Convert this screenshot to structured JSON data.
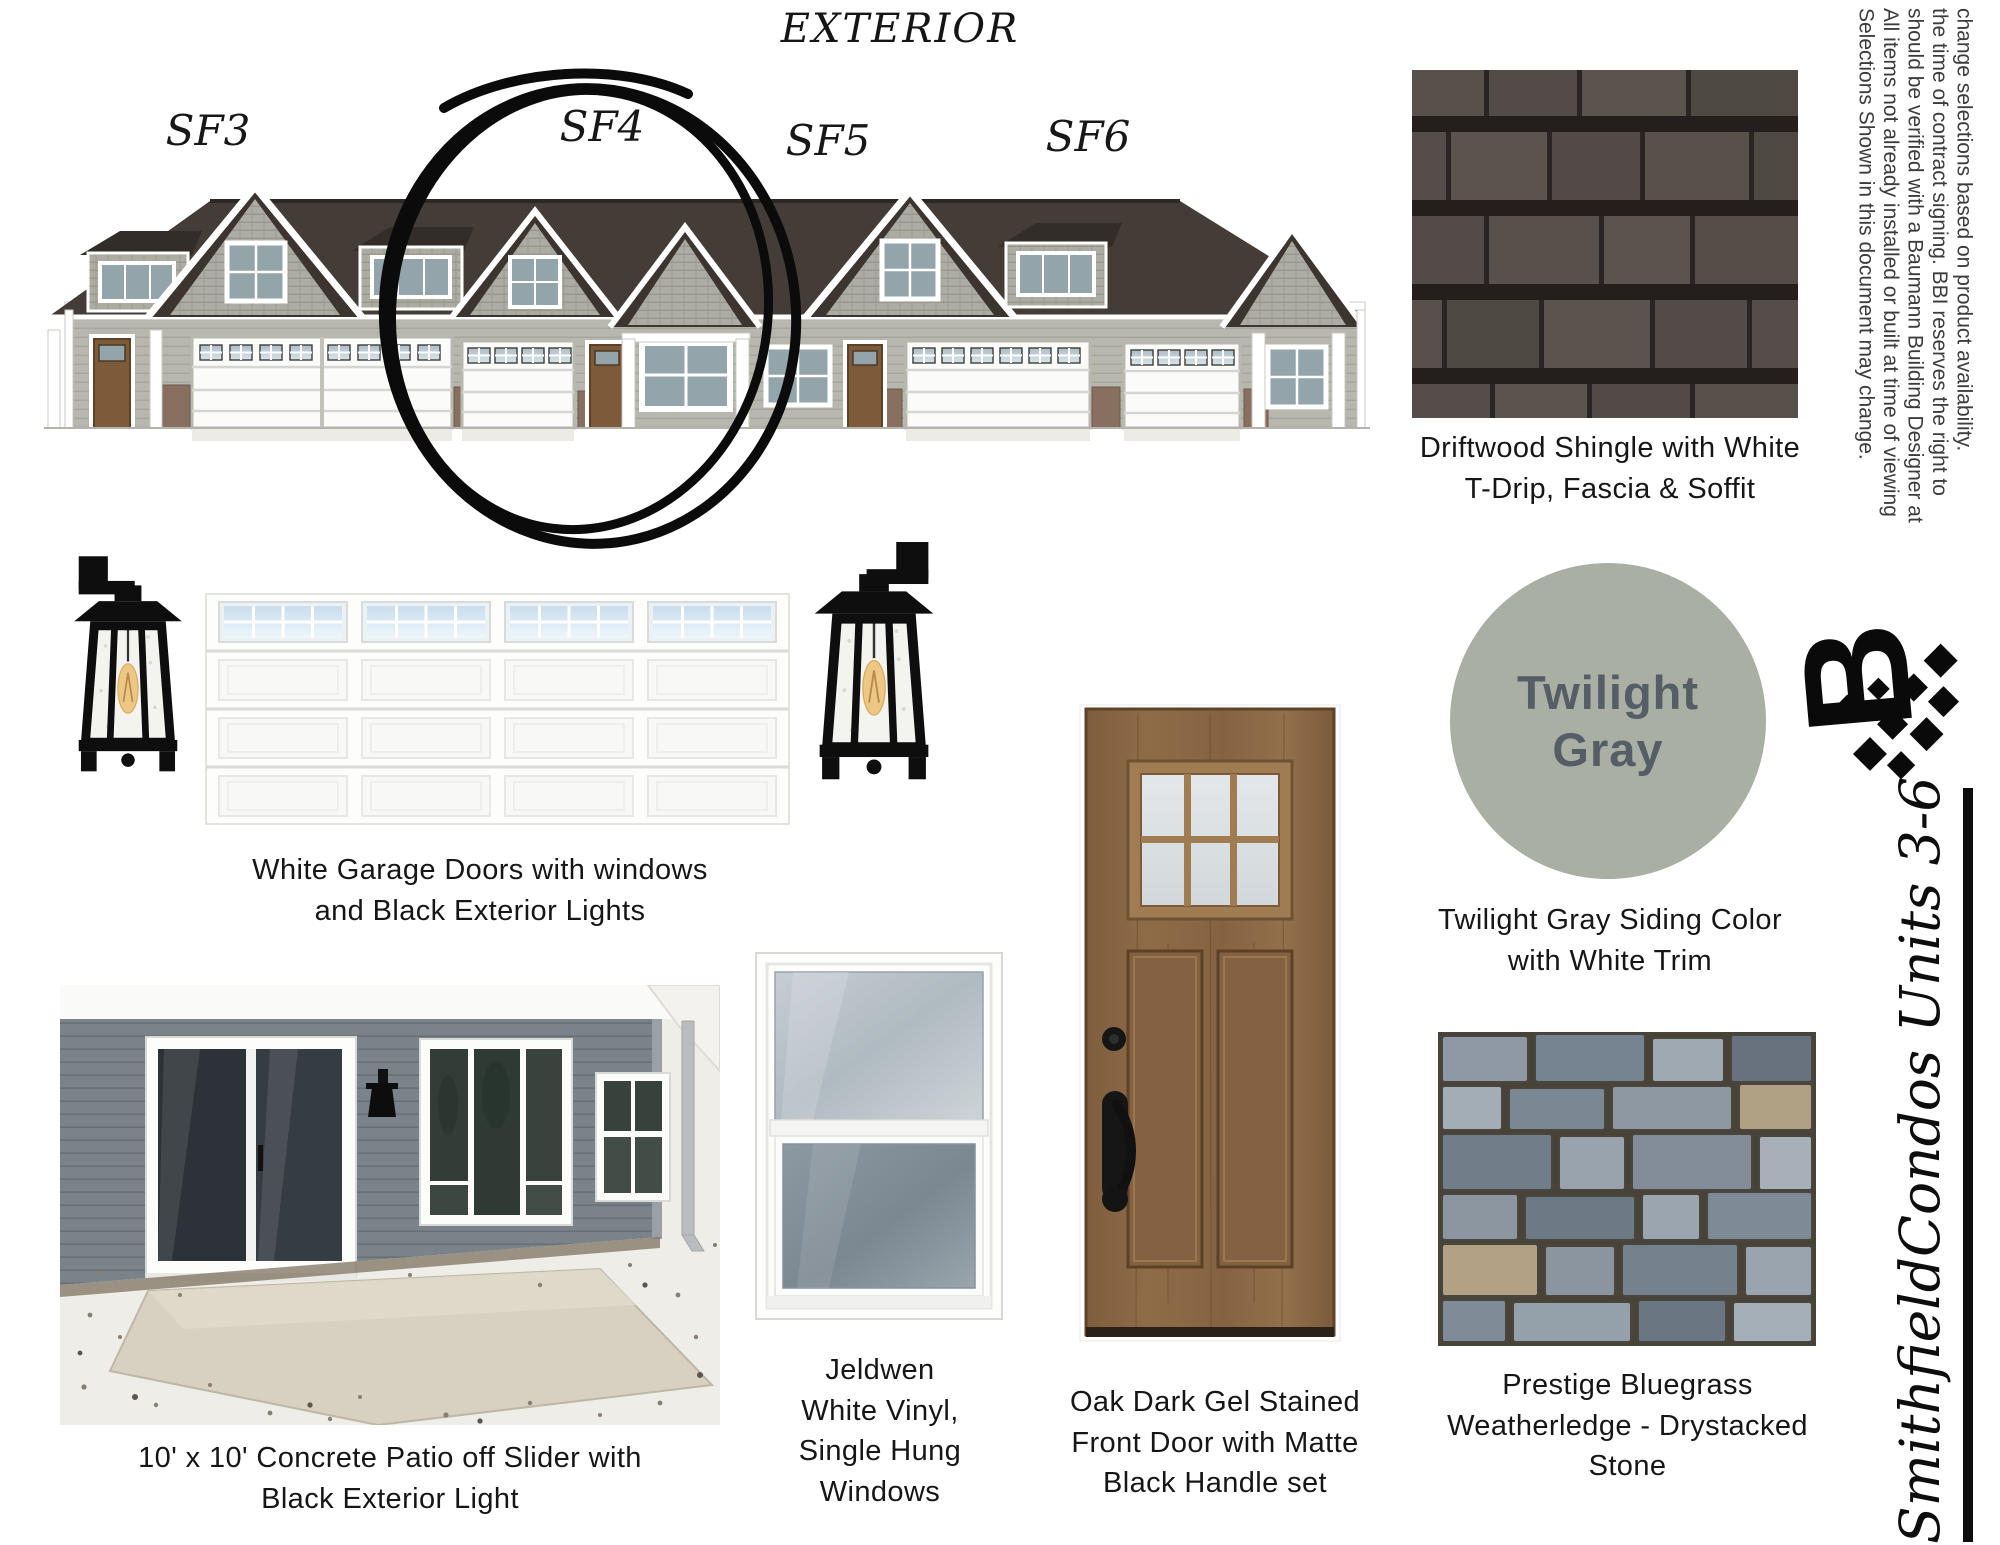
{
  "page": {
    "title": "EXTERIOR"
  },
  "rendering": {
    "unit_labels": [
      "SF3",
      "SF4",
      "SF5",
      "SF6"
    ],
    "circled_unit": "SF4"
  },
  "disclaimer": {
    "lines": [
      "Selections Shown in this document may change.",
      "All items not already installed or built at time of viewing",
      "should be verified with a Baumann Building Designer at",
      "the time of contract signing.  BBI reserves the right to",
      "change selections based on product availability."
    ]
  },
  "branding": {
    "logo_letter": "B",
    "project_title": "SmithfieldCondos Units 3-6"
  },
  "selections": {
    "shingle": {
      "caption": [
        "Driftwood Shingle with White",
        "T-Drip, Fascia & Soffit"
      ]
    },
    "garage": {
      "caption": [
        "White Garage Doors with windows",
        "and Black Exterior Lights"
      ]
    },
    "siding": {
      "swatch_label": [
        "Twilight",
        "Gray"
      ],
      "swatch_color": "#a9afa3",
      "caption": [
        "Twilight Gray Siding Color",
        "with White Trim"
      ]
    },
    "patio": {
      "caption": [
        "10' x 10' Concrete Patio off Slider with",
        "Black Exterior Light"
      ]
    },
    "window": {
      "caption": [
        "Jeldwen",
        "White Vinyl,",
        "Single Hung",
        "Windows"
      ]
    },
    "door": {
      "caption": [
        "Oak Dark Gel Stained",
        "Front Door with Matte",
        "Black Handle set"
      ]
    },
    "stone": {
      "caption": [
        "Prestige Bluegrass",
        "Weatherledge - Drystacked",
        "Stone"
      ]
    }
  },
  "colors": {
    "annotation_ink": "#0d0d0d",
    "twilight_gray": "#a9afa3",
    "shingle_base": "#534c48",
    "stone_base": "#8d98a3"
  }
}
